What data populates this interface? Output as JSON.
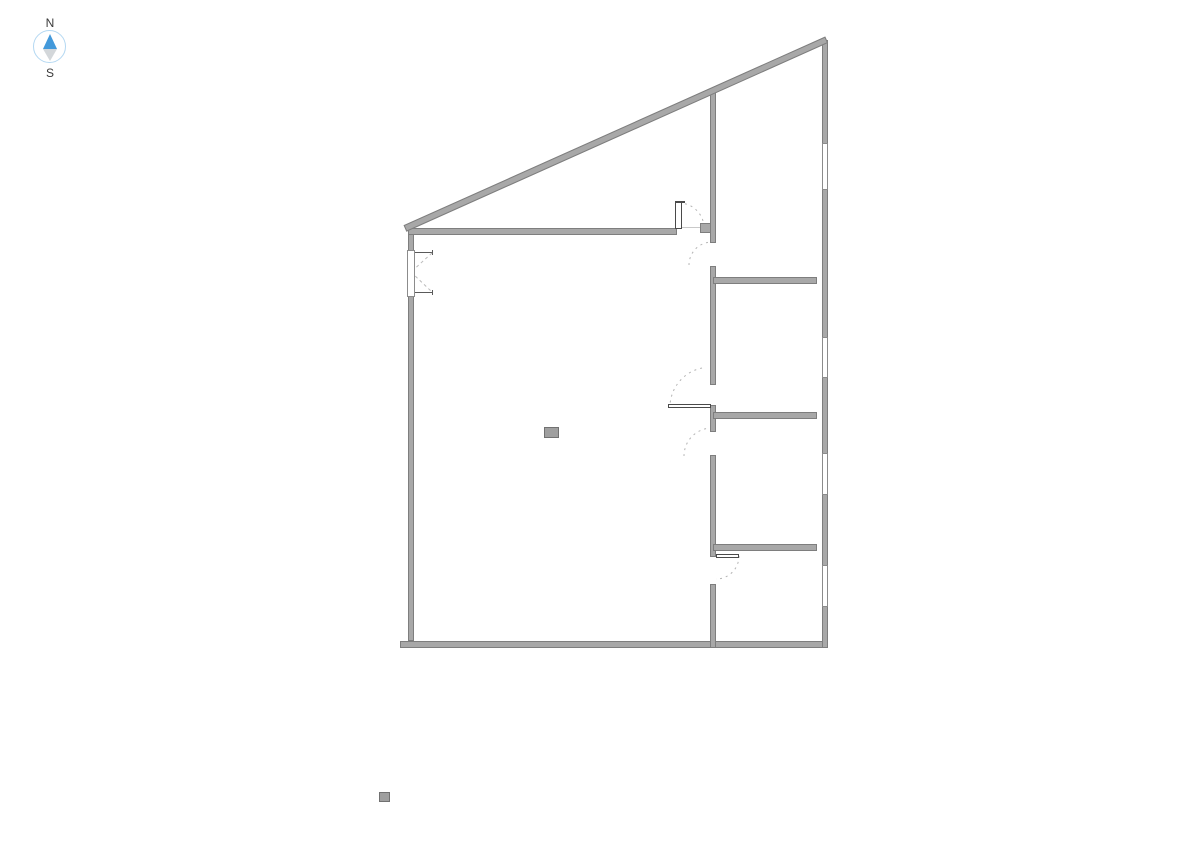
{
  "compass": {
    "north_label": "N",
    "south_label": "S",
    "ring_color": "#b4d8f2",
    "north_needle_color": "#4399da",
    "south_needle_color": "#d3d7da",
    "label_color": "#3a3a3a"
  },
  "floorplan": {
    "background_color": "#ffffff",
    "wall_fill": "#a8a8a8",
    "wall_border": "#7e7e7e",
    "window_border": "#8c8c8c",
    "leaf_border": "#4a4a4a",
    "arc_color": "#b4b4b4",
    "marker_fill": "#9f9f9f",
    "marker_border": "#717171",
    "walls": [
      {
        "name": "wall-left",
        "x": 408,
        "y": 228,
        "w": 6,
        "h": 413
      },
      {
        "name": "wall-top-interior",
        "x": 408,
        "y": 228,
        "w": 269,
        "h": 7
      },
      {
        "name": "wall-top-door-jamb-block",
        "x": 700,
        "y": 223,
        "w": 16,
        "h": 10
      },
      {
        "name": "wall-bottom",
        "x": 400,
        "y": 641,
        "w": 428,
        "h": 7
      },
      {
        "name": "wall-right",
        "x": 822,
        "y": 40,
        "w": 6,
        "h": 608
      },
      {
        "name": "wall-core-segment-1",
        "x": 710,
        "y": 90,
        "w": 6,
        "h": 153
      },
      {
        "name": "wall-core-segment-2",
        "x": 710,
        "y": 266,
        "w": 6,
        "h": 119
      },
      {
        "name": "wall-core-segment-3",
        "x": 710,
        "y": 405,
        "w": 6,
        "h": 27
      },
      {
        "name": "wall-core-segment-4",
        "x": 710,
        "y": 455,
        "w": 6,
        "h": 102
      },
      {
        "name": "wall-core-segment-5",
        "x": 710,
        "y": 584,
        "w": 6,
        "h": 64
      },
      {
        "name": "wall-room-divider-1",
        "x": 713,
        "y": 277,
        "w": 104,
        "h": 7
      },
      {
        "name": "wall-room-divider-2",
        "x": 713,
        "y": 412,
        "w": 104,
        "h": 7
      },
      {
        "name": "wall-room-divider-3",
        "x": 713,
        "y": 544,
        "w": 104,
        "h": 7
      }
    ],
    "diagonal_wall": {
      "name": "wall-diagonal-north",
      "x": 405,
      "y": 225,
      "length": 462,
      "thickness": 7,
      "angle_deg": -24.12
    },
    "windows": [
      {
        "name": "window-left-wall",
        "x": 407,
        "y": 250,
        "w": 8,
        "h": 47
      },
      {
        "name": "window-right-wall-1",
        "x": 822,
        "y": 143,
        "w": 6,
        "h": 47
      },
      {
        "name": "window-right-wall-2",
        "x": 822,
        "y": 337,
        "w": 6,
        "h": 41
      },
      {
        "name": "window-right-wall-3",
        "x": 822,
        "y": 453,
        "w": 6,
        "h": 42
      },
      {
        "name": "window-right-wall-4",
        "x": 822,
        "y": 565,
        "w": 6,
        "h": 42
      }
    ],
    "door_leaves": [
      {
        "name": "door-leaf-top",
        "x": 675,
        "y": 202,
        "w": 7,
        "h": 27
      },
      {
        "name": "door-leaf-top-cap",
        "x": 675,
        "y": 201,
        "w": 10,
        "h": 2,
        "fill": "#4a4a4a"
      },
      {
        "name": "door-leaf-middle",
        "x": 668,
        "y": 404,
        "w": 43,
        "h": 4
      },
      {
        "name": "door-leaf-bottom",
        "x": 716,
        "y": 554,
        "w": 23,
        "h": 4
      }
    ],
    "door_arcs": [
      {
        "name": "door-swing-arc-top",
        "path": "M 679,203 A 25 25 0 0 1 704,228"
      },
      {
        "name": "door-swing-arc-upper",
        "path": "M 689,265 A 23 23 0 0 1 712,242"
      },
      {
        "name": "door-swing-arc-middle",
        "path": "M 702,368 A 40 40 0 0 0 670,406"
      },
      {
        "name": "door-swing-arc-lower",
        "path": "M 712,428 A 28 28 0 0 0 684,456"
      },
      {
        "name": "door-swing-arc-bottom",
        "path": "M 739,556 A 23 23 0 0 1 716,579"
      }
    ],
    "lines": [
      {
        "name": "door-threshold-top",
        "path": "M 681,227.5 L 700,227.5",
        "color": "#c9c9c9"
      },
      {
        "name": "window-left-glass-line",
        "path": "M 410.5,250 L 410.5,297",
        "color": "#c4c4c4"
      },
      {
        "name": "window-left-jamb-top",
        "path": "M 408,252.5 L 433,252.5",
        "color": "#5a5a5a"
      },
      {
        "name": "window-left-jamb-top-tick",
        "path": "M 432.5,250 L 432.5,255",
        "color": "#5a5a5a"
      },
      {
        "name": "window-left-jamb-bottom",
        "path": "M 408,292.5 L 433,292.5",
        "color": "#5a5a5a"
      },
      {
        "name": "window-left-jamb-bottom-tick",
        "path": "M 432.5,290 L 432.5,295",
        "color": "#5a5a5a"
      },
      {
        "name": "window-left-opening-dash-1",
        "path": "M 432,253 L 411,272",
        "color": "#bbbbbb",
        "dash": "3 3"
      },
      {
        "name": "window-left-opening-dash-2",
        "path": "M 411,272 L 432,292",
        "color": "#bbbbbb",
        "dash": "3 3"
      }
    ],
    "markers": [
      {
        "name": "room-column-marker",
        "x": 544,
        "y": 427,
        "w": 15,
        "h": 11
      },
      {
        "name": "site-marker",
        "x": 379,
        "y": 792,
        "w": 11,
        "h": 10
      }
    ]
  }
}
